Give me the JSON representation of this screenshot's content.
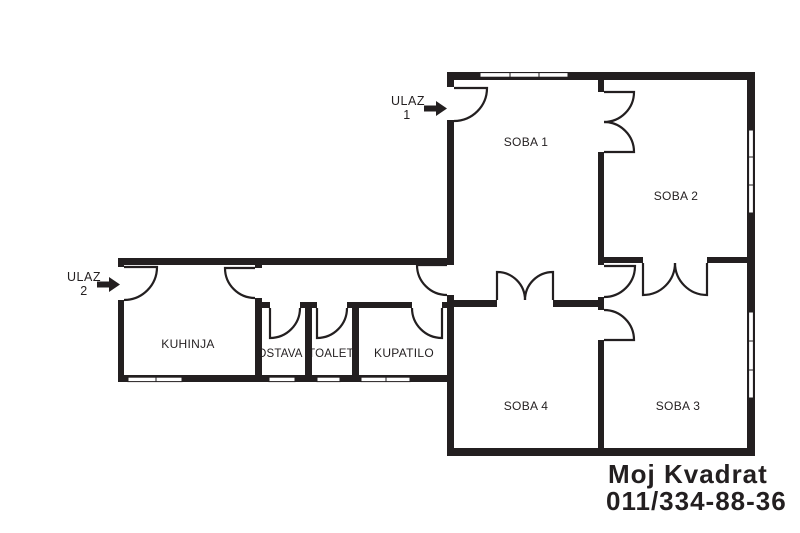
{
  "fp": {
    "rooms": {
      "soba1": "SOBA 1",
      "soba2": "SOBA 2",
      "soba3": "SOBA 3",
      "soba4": "SOBA 4",
      "kuhinja": "KUHINJA",
      "ostava": "OSTAVA",
      "toalet": "TOALET",
      "kupatilo": "KUPATILO"
    },
    "entrance1": {
      "word": "ULAZ",
      "number": "1"
    },
    "entrance2": {
      "word": "ULAZ",
      "number": "2"
    },
    "watermark": {
      "line1": "Moj Kvadrat",
      "line2": "011/334-88-36",
      "color": "#fcfc5a"
    },
    "colors": {
      "wall": "#231f20",
      "bg": "#ffffff"
    }
  }
}
